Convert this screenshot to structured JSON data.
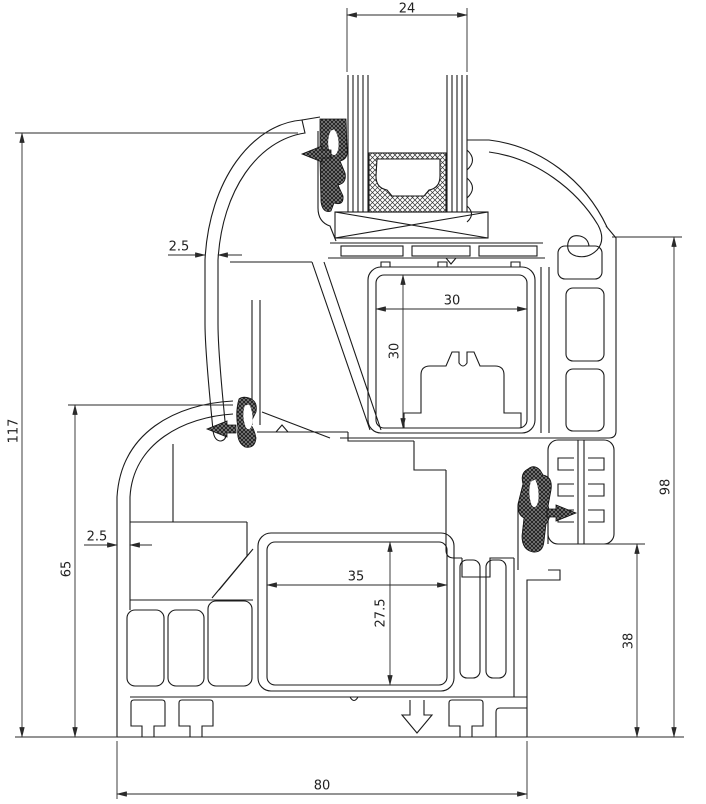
{
  "drawing": {
    "type": "technical-cross-section",
    "subject": "PVC window sash and frame profile section with insulated glazing",
    "units": "mm",
    "colors": {
      "line": "#1b1b1b",
      "dimension": "#2a2a2a",
      "background": "#ffffff",
      "seal_fill": "#1f1f1f"
    },
    "dimensions": {
      "glazing_width": "24",
      "sash_outer_wall_thickness": "2.5",
      "sash_reinforcement_width": "30",
      "sash_reinforcement_height": "30",
      "overall_height": "117",
      "frame_height": "65",
      "frame_outer_wall_thickness": "2.5",
      "frame_reinforcement_width": "35",
      "frame_reinforcement_height": "27.5",
      "sash_section_height": "98",
      "lower_right_height": "38",
      "profile_depth": "80"
    }
  }
}
